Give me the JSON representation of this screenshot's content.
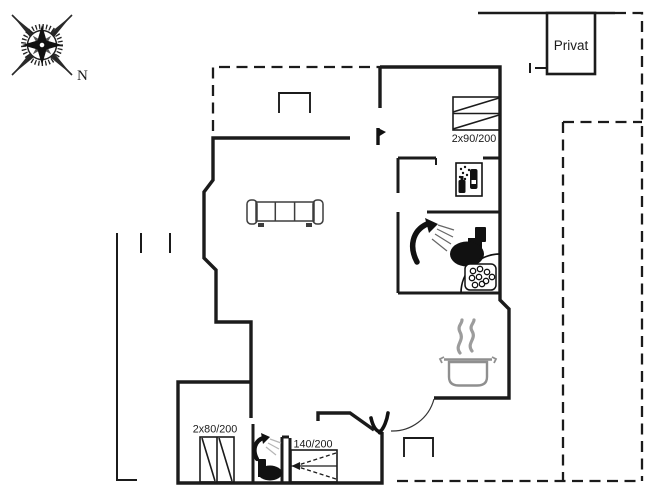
{
  "meta": {
    "type": "holiday-house-floor-plan",
    "background": "#ffffff",
    "wall_color": "#1b1b1b",
    "gray_accent": "#8f8f8f"
  },
  "compass": {
    "north_label": "N"
  },
  "annex": {
    "label": "Privat"
  },
  "labels": {
    "bed_double_right": "2x90/200",
    "bed_double_left": "2x80/200",
    "sofa_bed": "140/200"
  },
  "fixtures": {
    "living_room": [
      "sofa-icon"
    ],
    "bedroom_top_right": [
      "double-bed-icon"
    ],
    "utility_room": [
      "washing-machine-icon"
    ],
    "bathroom_main": [
      "shower-icon",
      "toilet-icon",
      "corner-sink-icon"
    ],
    "kitchen": [
      "cooking-pot-icon"
    ],
    "bedroom_bottom_left": [
      "twin-bed-icon"
    ],
    "bathroom_second": [
      "shower-icon",
      "toilet-icon"
    ],
    "bedroom_bottom_middle": [
      "sofa-bed-icon"
    ],
    "entrance": [
      "door-leaf-icon",
      "door-swing-icon"
    ]
  }
}
